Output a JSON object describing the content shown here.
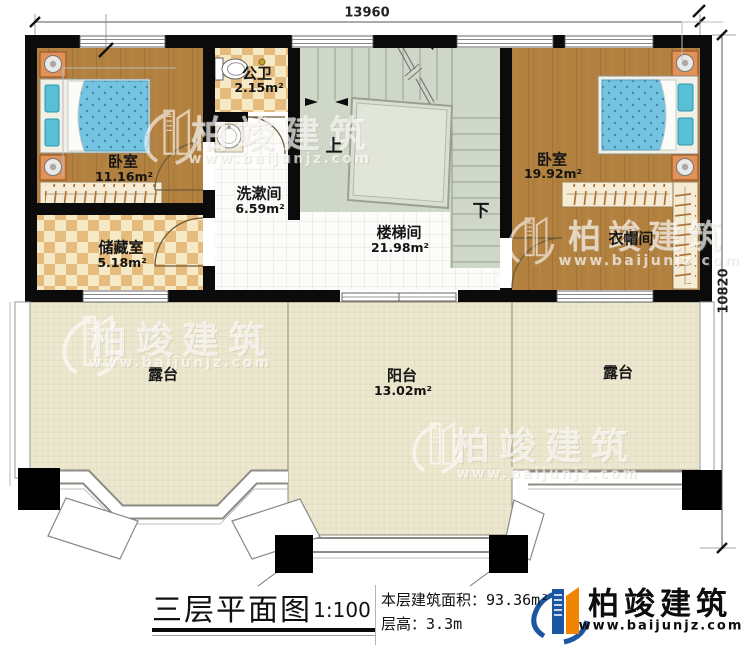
{
  "plan": {
    "dimensions": {
      "width_mm": "13960",
      "height_mm": "10820"
    },
    "rooms": {
      "bedroom_left": {
        "name": "卧室",
        "area": "11.16m²"
      },
      "bathroom": {
        "name": "公卫",
        "area": "2.15m²"
      },
      "washroom": {
        "name": "洗漱间",
        "area": "6.59m²"
      },
      "storage": {
        "name": "储藏室",
        "area": "5.18m²"
      },
      "stairwell": {
        "name": "楼梯间",
        "area": "21.98m²"
      },
      "bedroom_right": {
        "name": "卧室",
        "area": "19.92m²"
      },
      "cloakroom": {
        "name": "衣帽间"
      },
      "terrace_left": {
        "name": "露台"
      },
      "balcony": {
        "name": "阳台",
        "area": "13.02m²"
      },
      "terrace_right": {
        "name": "露台"
      }
    },
    "stairs": {
      "up_label": "上",
      "down_label": "下"
    }
  },
  "title_block": {
    "title": "三层平面图",
    "scale": "1:100",
    "floor_area_label": "本层建筑面积：",
    "floor_area_value": "93.36m²",
    "floor_height_label": "层高：",
    "floor_height_value": "3.3m"
  },
  "brand": {
    "name": "柏竣建筑",
    "website": "www.baijunjz.com"
  },
  "watermark": {
    "name": "柏竣建筑",
    "website": "www.baijunjz.com"
  },
  "colors": {
    "wall": "#0b0b0b",
    "wood_floor": "#b2813f",
    "tile_light": "#f6e9c6",
    "tile_dark": "#e5bc7e",
    "stair_floor": "#cfd7c9",
    "terrace_floor": "#ece7cf",
    "bed_blue": "#74c3e0",
    "brand_blue": "#1a57a0",
    "brand_orange": "#f08300"
  }
}
